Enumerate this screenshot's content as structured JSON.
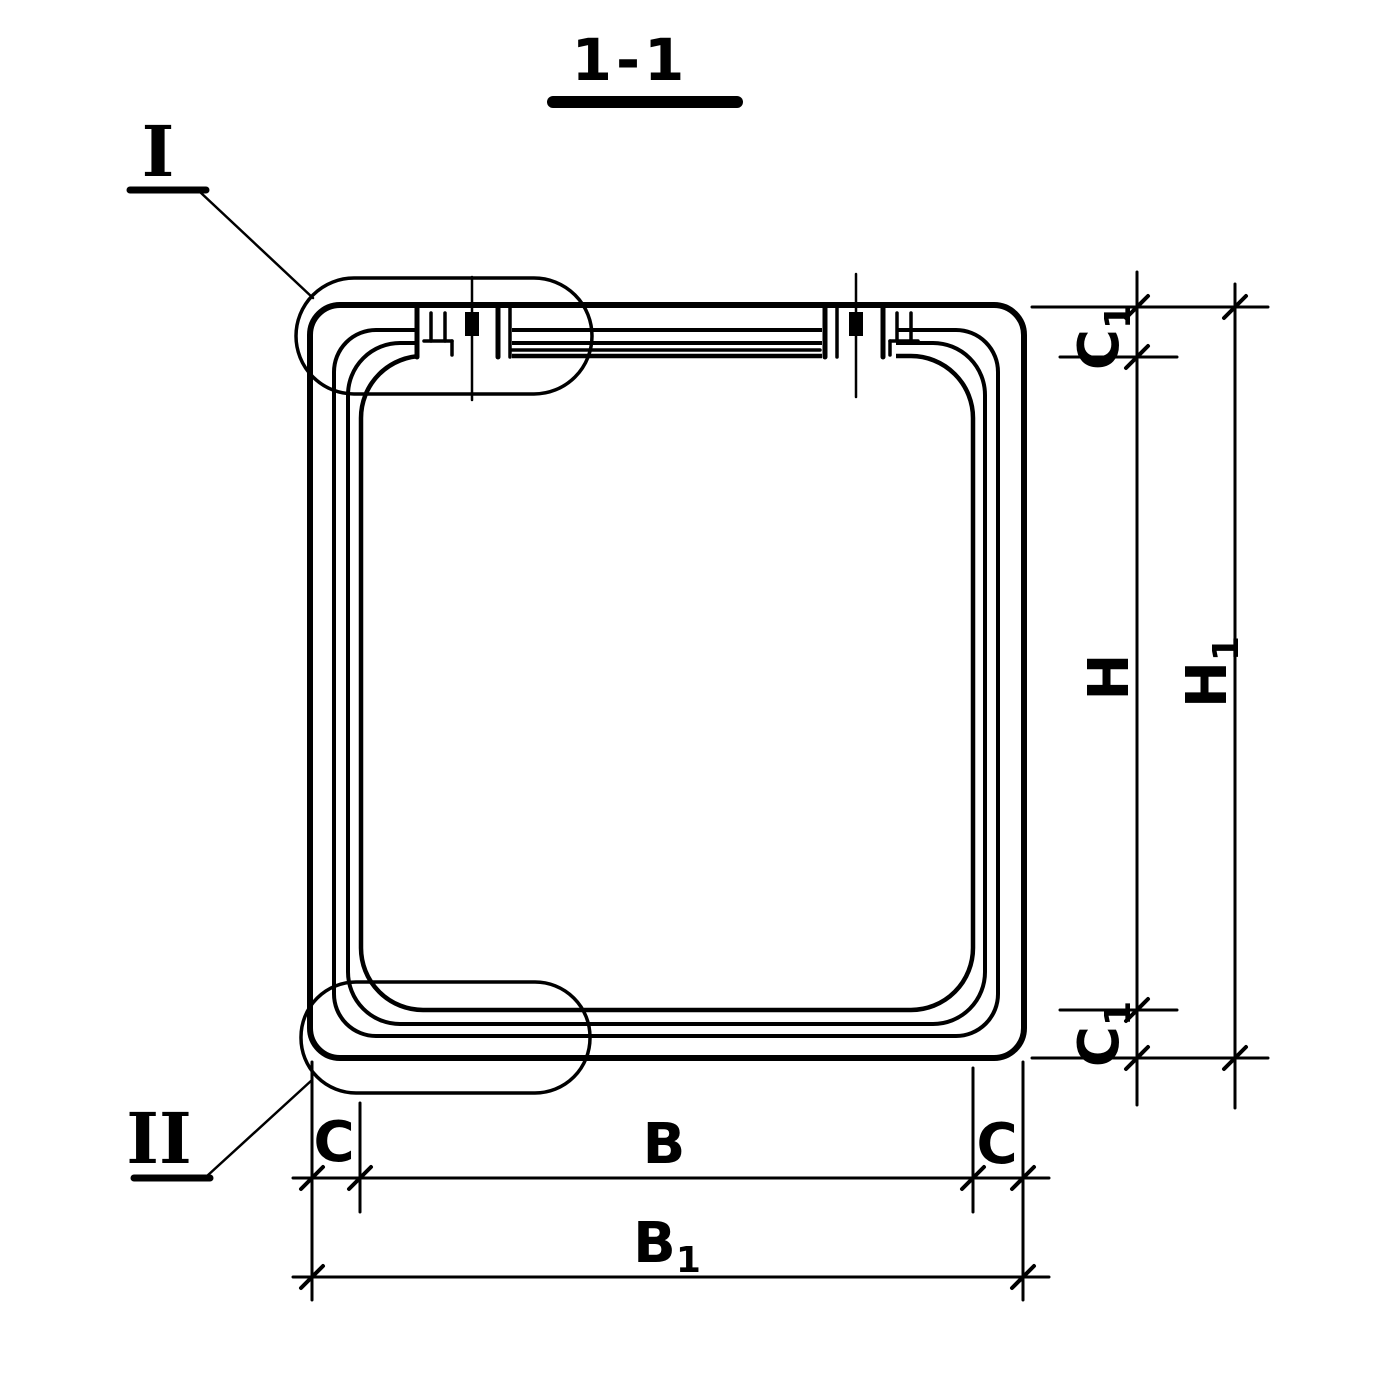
{
  "sheet": {
    "paper_color": "#ffffff",
    "ink_color": "#000000",
    "description": "Section 1-1 of a precast box culvert link: square ring cross-section with rounded corners, two joints in the top slab, detail callouts I and II, dimension chains"
  },
  "title": {
    "text": "1-1"
  },
  "callouts": {
    "detail_1": {
      "numeral": "I"
    },
    "detail_2": {
      "numeral": "II"
    }
  },
  "dims": {
    "c1_top": {
      "label": "C",
      "sub": "1"
    },
    "h": {
      "label": "H",
      "sub": ""
    },
    "h1": {
      "label": "H",
      "sub": "1"
    },
    "c1_bottom": {
      "label": "C",
      "sub": "1"
    },
    "c_left": {
      "label": "C",
      "sub": ""
    },
    "b": {
      "label": "B",
      "sub": ""
    },
    "c_right": {
      "label": "C",
      "sub": ""
    },
    "b1": {
      "label": "B",
      "sub": "1"
    }
  }
}
